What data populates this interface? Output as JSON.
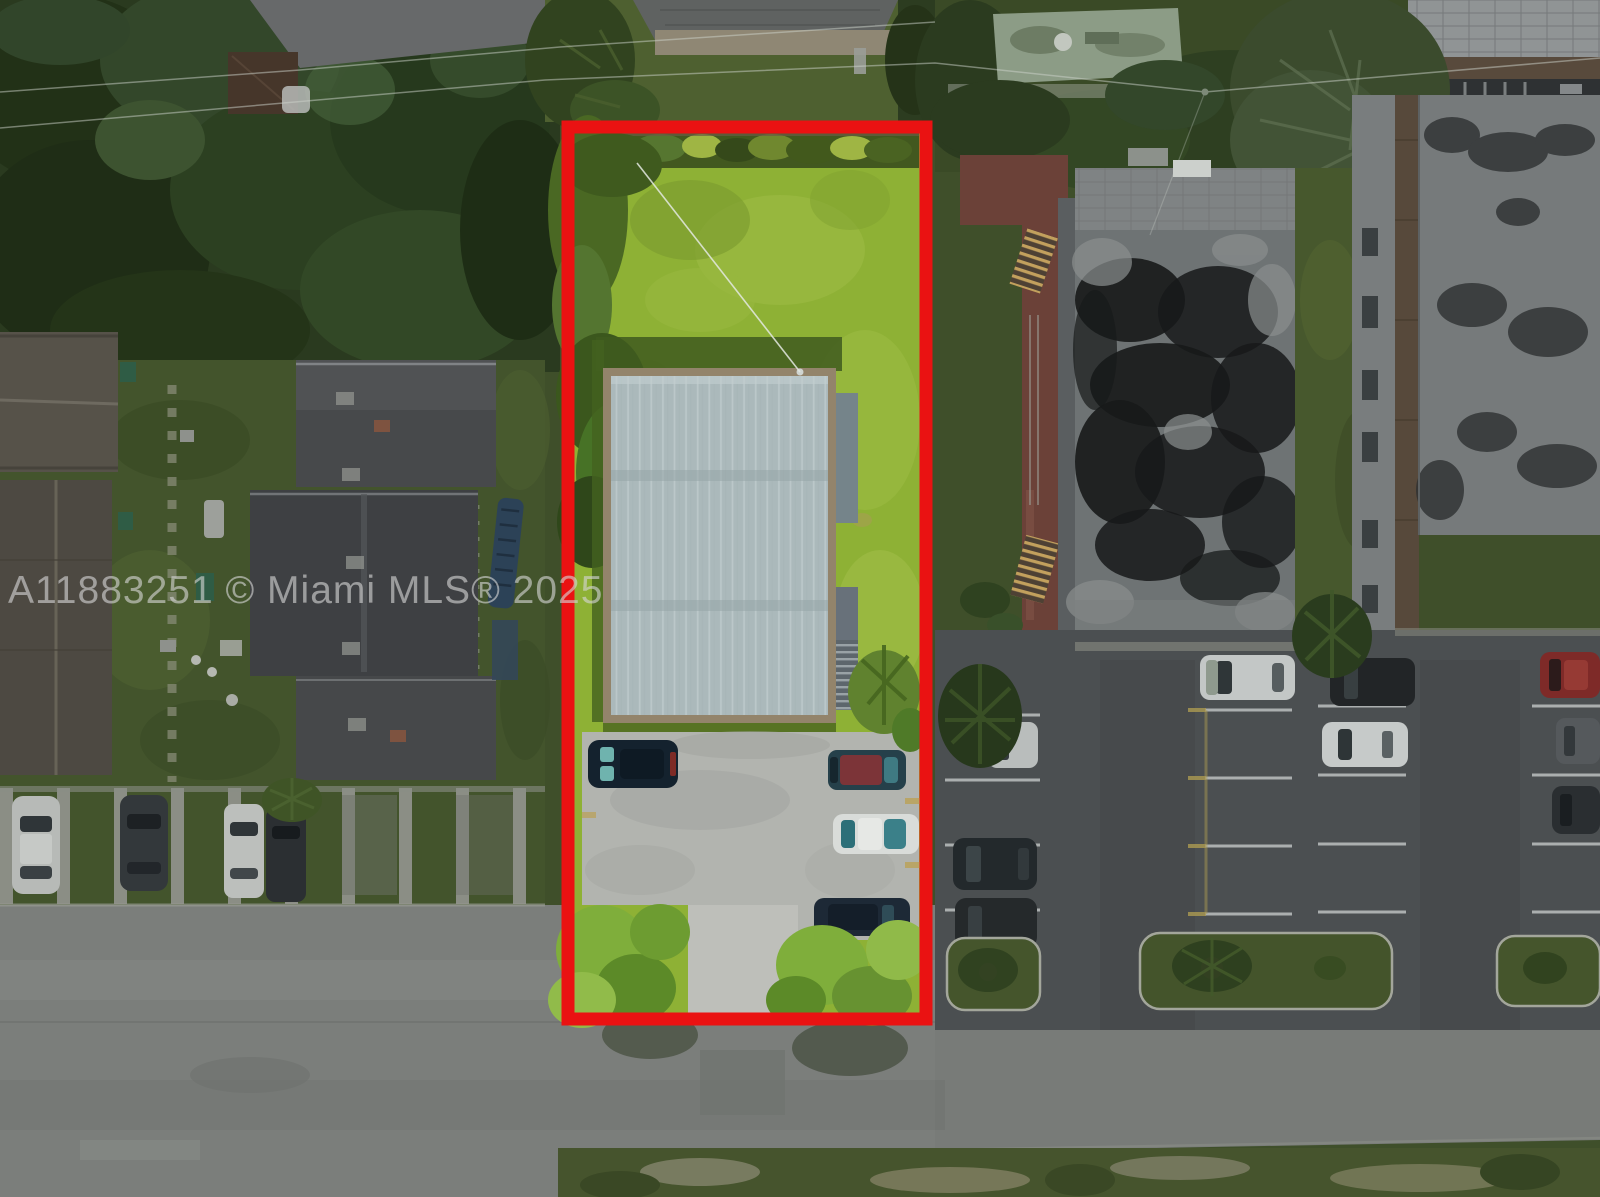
{
  "watermark": {
    "text": "A11883251 © Miami MLS® 2025",
    "color": "#d6d6d6"
  },
  "scene": {
    "description": "Top-down aerial drone photo of a residential lot outlined in red (MLS listing photo), bright highlighted parcel among darkened neighboring apartment buildings, parking lots and streets",
    "highlighted_property": {
      "outline_color": "#ea1212",
      "lawn_color": "#8eb135",
      "roof_color": "#abb9bb",
      "roof_border_color": "#95866c",
      "pad_color": "#b2b4af",
      "cars": [
        "dark teal SUV",
        "maroon-roof sedan",
        "white sedan",
        "dark navy sedan"
      ]
    },
    "surroundings": {
      "left_street_color": "#7b7e7b",
      "right_parking_color": "#4b4f51",
      "big_roof_stain_color": "#17191a",
      "walkway_color": "#6b4138",
      "street_parked_cars": [
        "white",
        "dark gray",
        "white",
        "black"
      ],
      "lot_parked_cars": [
        "white compact",
        "dark SUV",
        "dark sedan",
        "white sedan",
        "dark SUV",
        "white sedan",
        "red sedan",
        "gray sedan",
        "dark sedan"
      ],
      "neighbors": [
        "dark gabled apartment roofs (west)",
        "black-stained flat roof building (east)",
        "gray flat roof building (far east)",
        "green flat roof building (north)"
      ]
    }
  }
}
